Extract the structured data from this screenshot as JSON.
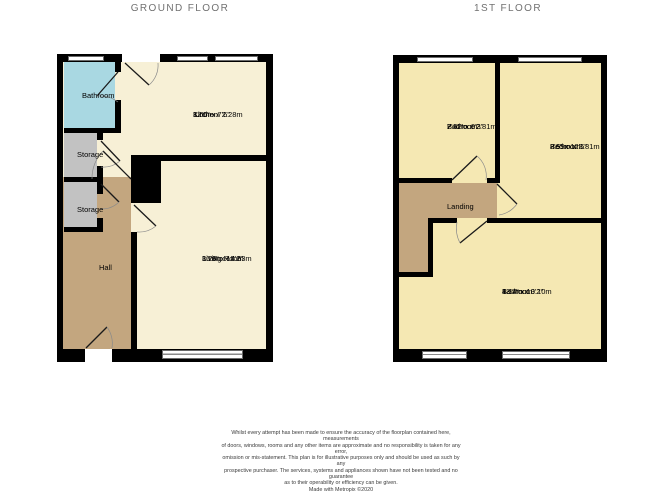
{
  "titles": {
    "ground": "GROUND FLOOR",
    "first": "1ST FLOOR"
  },
  "ground_floor": {
    "bathroom": {
      "label": "Bathroom"
    },
    "kitchen": {
      "label": "Kitchen",
      "metric": "3.66m x 2.28m",
      "imperial": "12'0\" x 7'6\""
    },
    "storage_1": {
      "label": "Storage"
    },
    "storage_2": {
      "label": "Storage"
    },
    "hall": {
      "label": "Hall"
    },
    "living_room": {
      "label": "Living Room",
      "metric": "3.26m x 4.63m",
      "imperial": "10'8\" x 15'2\""
    }
  },
  "first_floor": {
    "bedroom_1": {
      "label": "Bedroom",
      "metric": "2.42m x 2.81m",
      "imperial": "7'11\" x 9'3\""
    },
    "bedroom_2": {
      "label": "Bedroom",
      "metric": "2.59m x 3.81m",
      "imperial": "8'6\" x 12'6\""
    },
    "landing": {
      "label": "Landing"
    },
    "bedroom_3": {
      "label": "Bedroom",
      "metric": "4.14m x 3.10m",
      "imperial": "13'7\" x 10'2\""
    }
  },
  "disclaimer": {
    "lines": [
      "Whilst every attempt has been made to ensure the accuracy of the floorplan contained here, measurements",
      "of doors, windows, rooms and any other items are approximate and no responsibility is taken for any error,",
      "omission or mis-statement. This plan is for illustrative purposes only and should be used as such by any",
      "prospective purchaser. The services, systems and appliances shown have not been tested and no guarantee",
      "as to their operability or efficiency can be given.",
      "Made with Metropix ©2020"
    ]
  },
  "colors": {
    "wall": "#000000",
    "room_ground": "#f7f0d6",
    "room_first": "#f5e8b3",
    "bathroom": "#a9d8e2",
    "storage": "#c2c2c2",
    "hall": "#c3a67f",
    "title_text": "#717171"
  }
}
